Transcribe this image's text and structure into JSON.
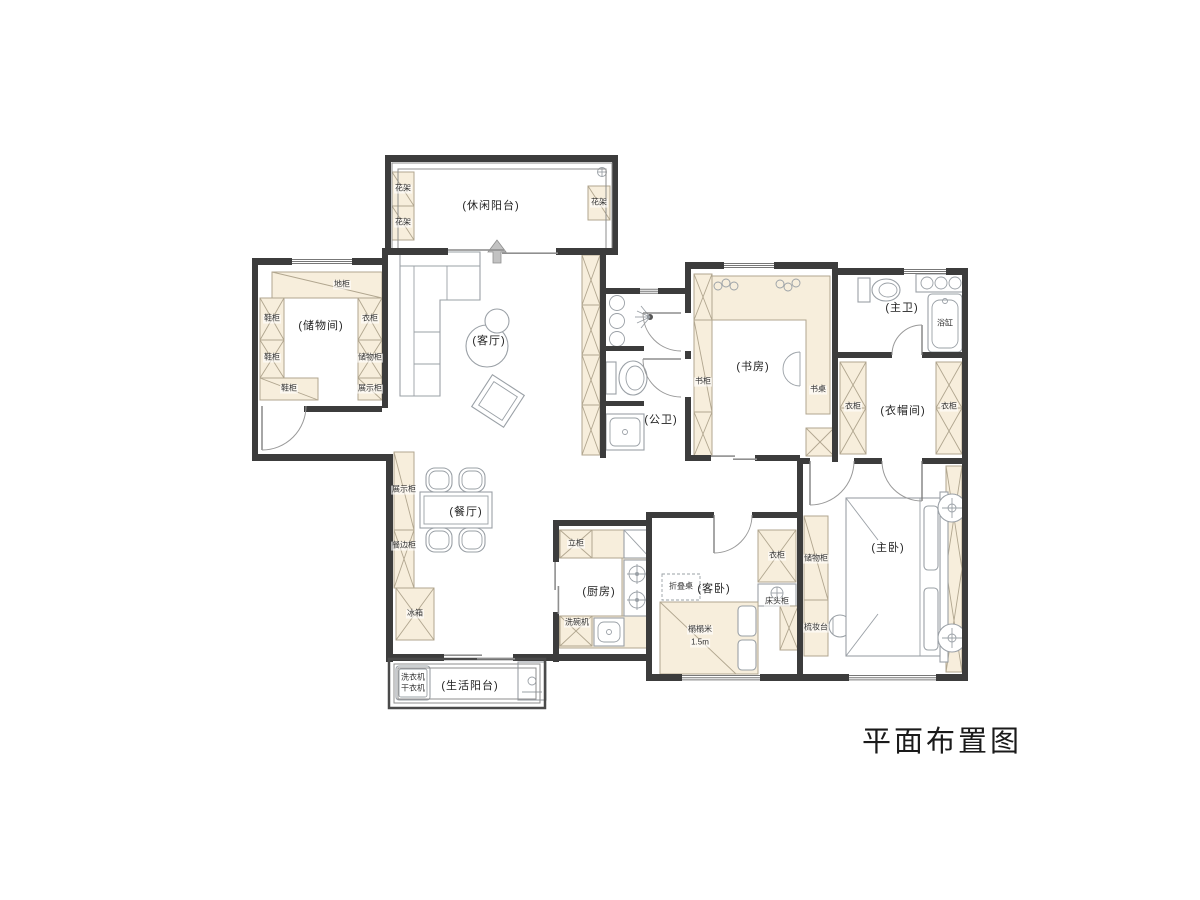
{
  "title": "平面布置图",
  "rooms": {
    "leisure_balcony": "(休闲阳台)",
    "storage_room": "(储物间)",
    "living_room": "(客厅)",
    "public_bath": "(公卫)",
    "study": "(书房)",
    "master_bath": "(主卫)",
    "closet": "(衣帽间)",
    "dining_room": "(餐厅)",
    "kitchen": "(厨房)",
    "guest_bedroom": "(客卧)",
    "master_bedroom": "(主卧)",
    "life_balcony": "(生活阳台)"
  },
  "furniture": {
    "flower_rack": "花架",
    "floor_cabinet": "地柜",
    "shoe_cabinet": "鞋柜",
    "wardrobe": "衣柜",
    "storage_cabinet": "储物柜",
    "display_cabinet": "展示柜",
    "bookcase": "书柜",
    "desk": "书桌",
    "bathtub": "浴缸",
    "sideboard": "餐边柜",
    "fridge": "冰箱",
    "tall_cabinet": "立柜",
    "dishwasher": "洗碗机",
    "folding_table": "折叠桌",
    "nightstand": "床头柜",
    "tatami": "榻榻米",
    "tatami_size": "1.5m",
    "dresser": "梳妆台",
    "washer": "洗衣机",
    "dryer": "干衣机"
  },
  "colors": {
    "wall": "#3c3c3c",
    "cabinet_fill": "#f7eedc",
    "line": "#9aa0a6"
  }
}
